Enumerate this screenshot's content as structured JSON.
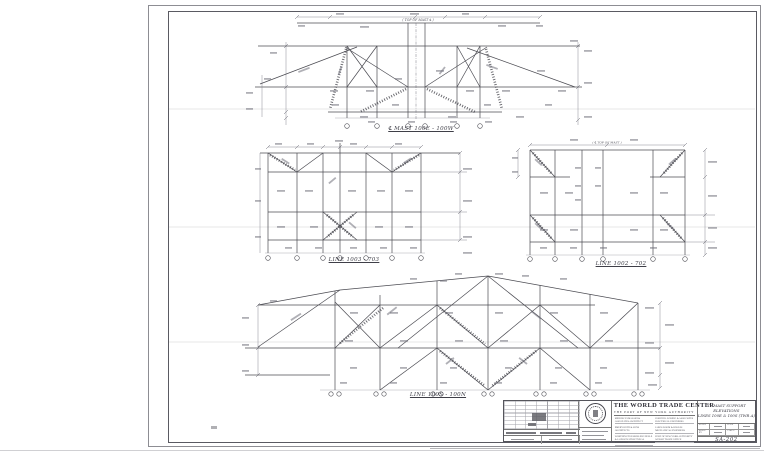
{
  "colors": {
    "ink": "#4b4b52",
    "dim": "#80808a",
    "paper": "#ffffff"
  },
  "diagrams": {
    "top": {
      "caption": "℄ MAST 100E - 100W",
      "top_label": "( TOP OF MAST ℄ )"
    },
    "mid_left": {
      "caption": "LINE 1003 - 703"
    },
    "mid_right": {
      "caption": "LINE 1002 - 702",
      "top_label": "( ℄ TOP OF MAST )"
    },
    "bottom": {
      "caption": "LINE 100S - 100N"
    }
  },
  "title_block": {
    "project": "THE WORLD TRADE CENTER",
    "owner": "THE PORT OF NEW YORK AUTHORITY",
    "firms_left": [
      "MINORU YAMASAKI & ASSOCIATES ARCHITECT",
      "EMERY ROTH & SONS ARCHITECTS",
      "WORTHINGTON SKILLING HELLE & JACKSON STRUCTURAL ENGINEERS"
    ],
    "firms_right": [
      "JOSEPH R. LORING & ASSOCIATES ELECTRICAL ENGINEERS",
      "JAROS BAUM & BOLLES MECHANICAL ENGINEERS",
      "PORT OF NEW YORK AUTHORITY WORLD TRADE OFFICE"
    ],
    "sheet_title_lines": [
      "TV MAST SUPPORT",
      "ELEVATIONS",
      "LINES 100E & 100S (TWR A)"
    ],
    "field_labels": [
      "SCALE",
      "DATE",
      "MADE BY",
      "CHK'D"
    ],
    "drawing_number": "SA-202"
  }
}
